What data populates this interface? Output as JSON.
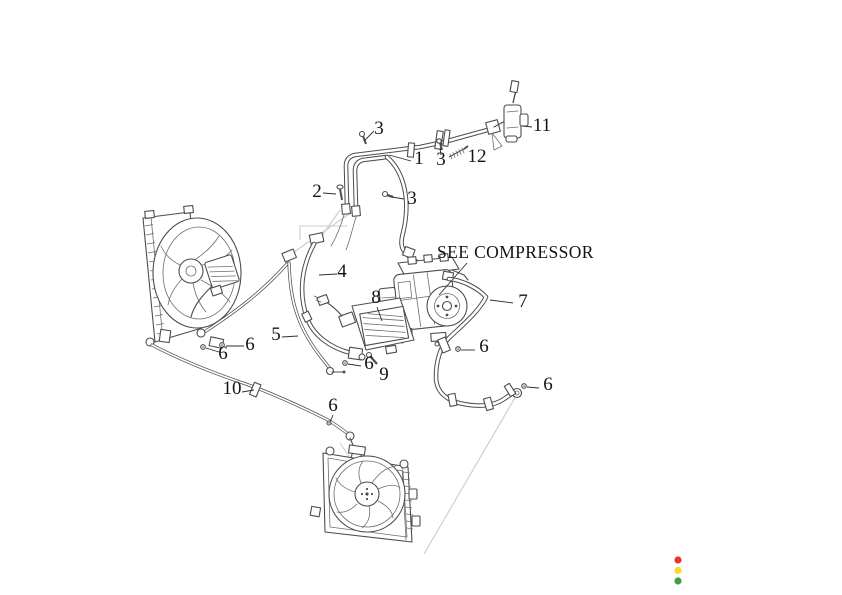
{
  "diagram": {
    "note": {
      "text": "SEE COMPRESSOR"
    },
    "callouts": [
      {
        "id": "3-top-bolt",
        "label": "3"
      },
      {
        "id": "1-pipe-assembly",
        "label": "1"
      },
      {
        "id": "3-mid-bolt",
        "label": "3"
      },
      {
        "id": "12-spring",
        "label": "12"
      },
      {
        "id": "11-valve",
        "label": "11"
      },
      {
        "id": "2-screw",
        "label": "2"
      },
      {
        "id": "3-low-bolt",
        "label": "3"
      },
      {
        "id": "4-hose",
        "label": "4"
      },
      {
        "id": "8-cooler",
        "label": "8"
      },
      {
        "id": "7-hose",
        "label": "7"
      },
      {
        "id": "5-pipe",
        "label": "5"
      },
      {
        "id": "6-hose7-upper",
        "label": "6"
      },
      {
        "id": "6-radiator-a",
        "label": "6"
      },
      {
        "id": "6-radiator-b",
        "label": "6"
      },
      {
        "id": "6-cooler",
        "label": "6"
      },
      {
        "id": "9-screw",
        "label": "9"
      },
      {
        "id": "6-hose7-end",
        "label": "6"
      },
      {
        "id": "10-pipe",
        "label": "10"
      },
      {
        "id": "6-pipe10",
        "label": "6"
      }
    ],
    "line_color": "#4d4d4d",
    "construction_line_color": "#cccccc",
    "text_color": "#141414"
  },
  "status_indicator": {
    "dots": [
      {
        "name": "red",
        "color": "#e5392e"
      },
      {
        "name": "yellow",
        "color": "#f6d929"
      },
      {
        "name": "green",
        "color": "#3fa047"
      }
    ]
  }
}
